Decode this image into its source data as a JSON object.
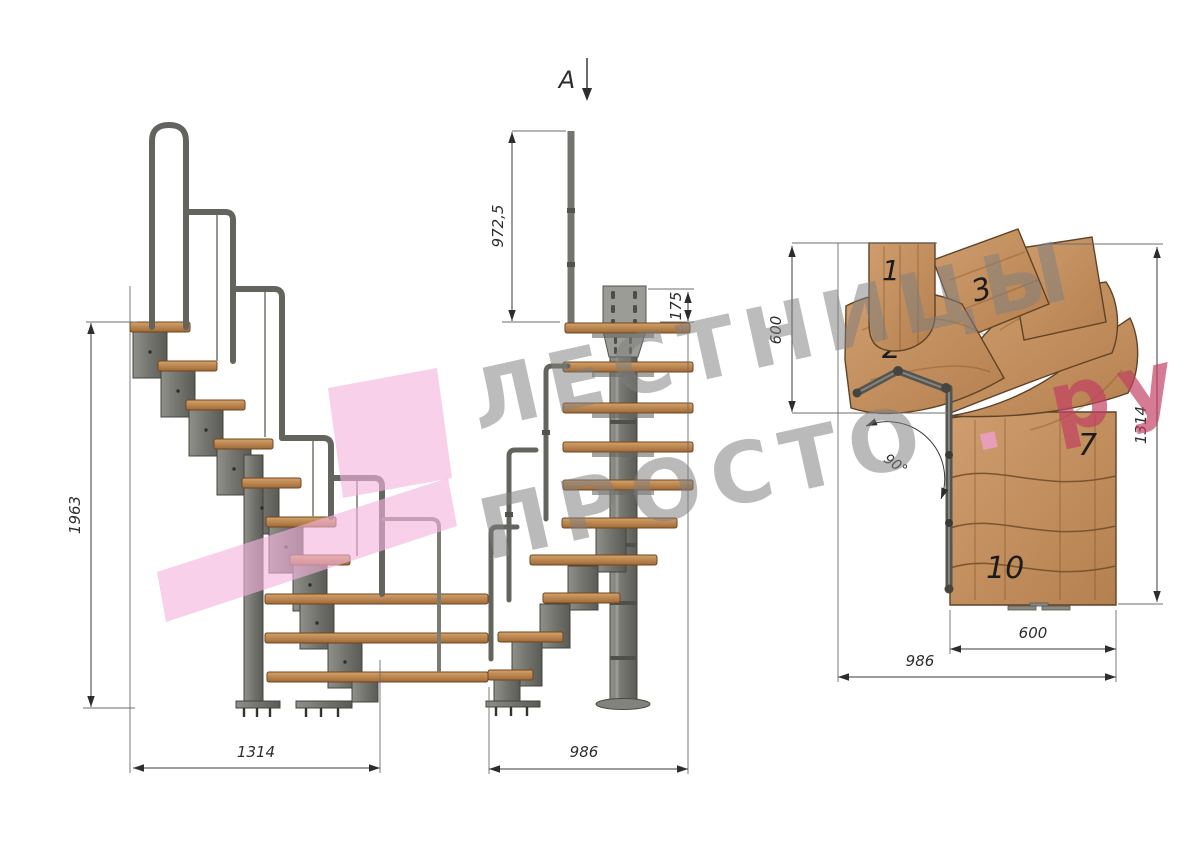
{
  "watermark": {
    "line1": "ЛЕСТНИЦЫ",
    "line2": "ПРОСТО",
    "dot": ".",
    "suffix": "ру"
  },
  "side_view": {
    "dim_height": "1963",
    "dim_width": "1314"
  },
  "front_view": {
    "section_label": "A",
    "dim_post_height": "972,5",
    "dim_plate": "175",
    "dim_width": "986"
  },
  "plan_view": {
    "dim_left_depth": "600",
    "dim_total_depth": "1314",
    "dim_tread_width": "600",
    "dim_total_width": "986",
    "angle_label": "90°",
    "steps": {
      "n1": "1",
      "n2": "2",
      "n3": "3",
      "n7": "7",
      "n10": "10"
    }
  },
  "colors": {
    "wood": "#c5905f",
    "metal": "#7e7e78",
    "watermark_gray": "#7f7f7f",
    "watermark_pink": "#c23f62",
    "ribbon_pink": "#f3b3dc"
  }
}
